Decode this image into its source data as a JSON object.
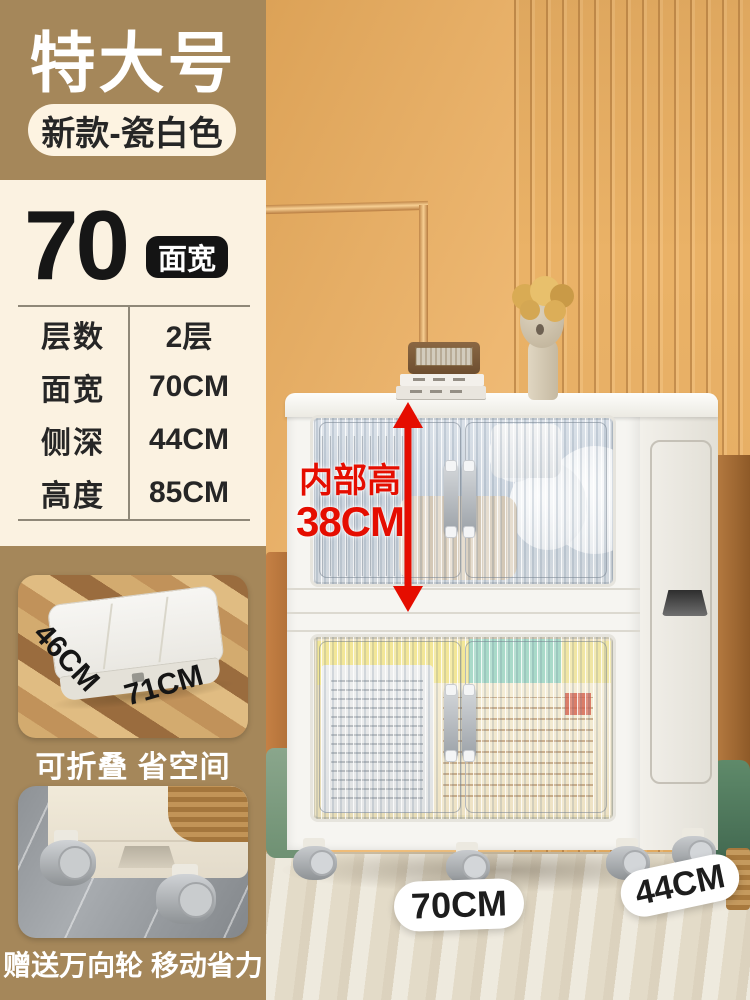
{
  "colors": {
    "accent_red": "#e50d00",
    "sidebar_tan": "#a5875a",
    "panel_cream": "#fbf2e1",
    "badge_black": "#141414",
    "wall_orange": "#eeb872"
  },
  "sidebar": {
    "size_tag": "特大号",
    "variant_pill": "新款-瓷白色",
    "width_value": "70",
    "width_unit_badge": "面宽",
    "specs": [
      {
        "label": "层数",
        "value": "2层"
      },
      {
        "label": "面宽",
        "value": "70CM"
      },
      {
        "label": "侧深",
        "value": "44CM"
      },
      {
        "label": "高度",
        "value": "85CM"
      }
    ],
    "folded_photo": {
      "depth_label": "46CM",
      "width_label": "71CM",
      "caption": "可折叠 省空间"
    },
    "wheels_photo": {
      "caption": "赠送万向轮 移动省力"
    }
  },
  "scene": {
    "inner_height_label_line1": "内部高",
    "inner_height_label_line2": "38CM",
    "front_width_label": "70CM",
    "side_depth_label": "44CM"
  }
}
